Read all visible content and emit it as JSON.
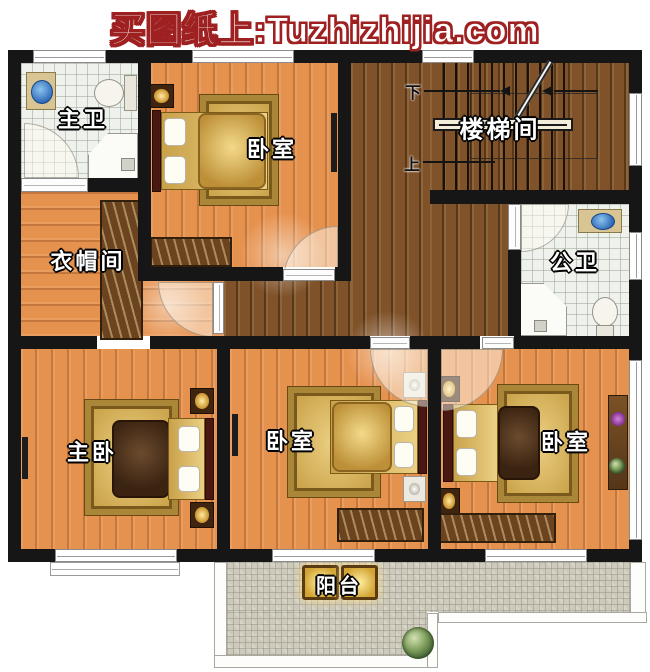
{
  "title": {
    "text": "买图纸上:Tuzhizhijia.com",
    "text_color": "#ffffff",
    "outline_color": "#9e2020"
  },
  "rooms": {
    "master_bath": {
      "label": "主卫"
    },
    "bedroom_top": {
      "label": "卧室"
    },
    "stairwell": {
      "label": "楼梯间"
    },
    "cloakroom": {
      "label": "衣帽间"
    },
    "public_bath": {
      "label": "公卫"
    },
    "master_bedroom": {
      "label": "主卧"
    },
    "bedroom_middle": {
      "label": "卧室"
    },
    "bedroom_right": {
      "label": "卧室"
    },
    "balcony": {
      "label": "阳台"
    }
  },
  "stairs": {
    "down_label": "下",
    "up_label": "上"
  },
  "colors": {
    "wall": "#161616",
    "wood_floor": "#e6924f",
    "walnut_floor": "#7f5229",
    "bathroom_tile": "#eff2ec",
    "balcony_tile": "#cdc9bb",
    "rug_gold": "#d2ab52",
    "label_text": "#ffffff",
    "title_outline": "#9e2020"
  }
}
